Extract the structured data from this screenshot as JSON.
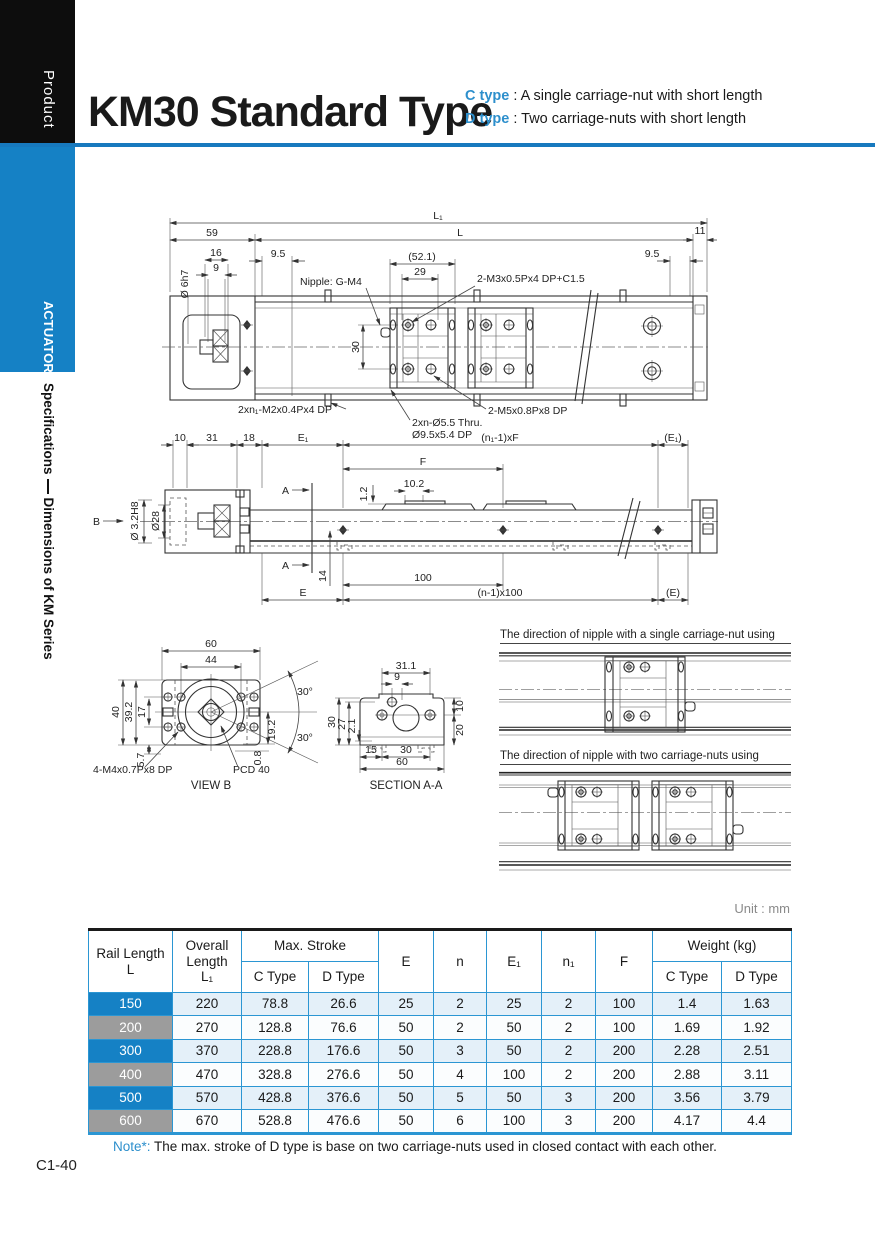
{
  "colors": {
    "accent_blue": "#1581c5",
    "rule_blue": "#1779be",
    "table_line_blue": "#2b96d3",
    "row_tint": "#e4f0f9",
    "row_label_gray": "#9c9c9c",
    "type_blue": "#2d8fcc"
  },
  "header": {
    "product": "Product",
    "title": "KM30 Standard Type",
    "c_type_label": "C type",
    "c_type_sep": " : ",
    "c_type_desc": "A single carriage-nut with short length",
    "d_type_label": "D type",
    "d_type_sep": " : ",
    "d_type_desc": "Two carriage-nuts with short length"
  },
  "sidebar": {
    "actuator": "ACTUATOR",
    "section_1": "Specifications",
    "section_2": "Dimensions of KM Series"
  },
  "drawings": {
    "top": {
      "dim_l1": "L₁",
      "dim_l": "L",
      "dim_59": "59",
      "dim_11": "11",
      "dim_16": "16",
      "dim_9": "9",
      "dim_d6": "Ø 6h7",
      "dim_95l": "9.5",
      "dim_521": "(52.1)",
      "dim_29": "29",
      "dim_30": "30",
      "dim_95r": "9.5",
      "lbl_nipple": "Nipple: G-M4",
      "lbl_m3": "2-M3x0.5Px4 DP+C1.5",
      "lbl_m2": "2xn₁-M2x0.4Px4 DP",
      "lbl_thru1": "2xn-Ø5.5 Thru.",
      "lbl_thru2": "Ø9.5x5.4 DP",
      "lbl_m5": "2-M5x0.8Px8 DP"
    },
    "side": {
      "dim_10": "10",
      "dim_31": "31",
      "dim_18": "18",
      "dim_e1": "E₁",
      "dim_nf": "(n₁-1)xF",
      "dim_e1p": "(E₁)",
      "dim_f": "F",
      "dim_12": "1.2",
      "dim_102": "10.2",
      "dim_d32": "Ø 3.2H8",
      "dim_d28": "Ø28",
      "lbl_b": "B",
      "lbl_a_top": "A",
      "lbl_a_bot": "A",
      "dim_14": "14",
      "dim_100": "100",
      "dim_e": "E",
      "dim_n100": "(n-1)x100",
      "dim_ep": "(E)"
    },
    "view_b": {
      "dim_60": "60",
      "dim_44": "44",
      "dim_40": "40",
      "dim_392": "39.2",
      "dim_17": "17",
      "dim_57": "5.7",
      "dim_30u": "30°",
      "dim_30l": "30°",
      "dim_192": "19.2",
      "dim_08": "0.8",
      "lbl_m4": "4-M4x0.7Px8 DP",
      "lbl_pcd": "PCD 40",
      "caption": "VIEW B"
    },
    "section_aa": {
      "dim_311": "31.1",
      "dim_9": "9",
      "dim_30": "30",
      "dim_27": "27",
      "dim_21": "2.1",
      "dim_10": "10",
      "dim_20": "20",
      "dim_15": "15",
      "dim_30b": "30",
      "dim_60": "60",
      "caption": "SECTION A-A"
    },
    "nipple": {
      "caption_single": "The direction of nipple with a single carriage-nut using",
      "caption_double": "The direction of nipple with two carriage-nuts using"
    }
  },
  "table": {
    "unit": "Unit : mm",
    "headers": {
      "rail_length": "Rail Length",
      "rail_length_sub": "L",
      "overall_1": "Overall",
      "overall_2": "Length",
      "overall_3": "L₁",
      "max_stroke": "Max. Stroke",
      "c_type": "C Type",
      "d_type": "D Type",
      "e": "E",
      "n": "n",
      "e1": "E₁",
      "n1": "n₁",
      "f": "F",
      "weight": "Weight (kg)",
      "c_type_w": "C Type",
      "d_type_w": "D Type"
    },
    "rows": [
      {
        "l": "150",
        "l1": "220",
        "c": "78.8",
        "d": "26.6",
        "e": "25",
        "n": "2",
        "e1": "25",
        "n1": "2",
        "f": "100",
        "wc": "1.4",
        "wd": "1.63"
      },
      {
        "l": "200",
        "l1": "270",
        "c": "128.8",
        "d": "76.6",
        "e": "50",
        "n": "2",
        "e1": "50",
        "n1": "2",
        "f": "100",
        "wc": "1.69",
        "wd": "1.92"
      },
      {
        "l": "300",
        "l1": "370",
        "c": "228.8",
        "d": "176.6",
        "e": "50",
        "n": "3",
        "e1": "50",
        "n1": "2",
        "f": "200",
        "wc": "2.28",
        "wd": "2.51"
      },
      {
        "l": "400",
        "l1": "470",
        "c": "328.8",
        "d": "276.6",
        "e": "50",
        "n": "4",
        "e1": "100",
        "n1": "2",
        "f": "200",
        "wc": "2.88",
        "wd": "3.11"
      },
      {
        "l": "500",
        "l1": "570",
        "c": "428.8",
        "d": "376.6",
        "e": "50",
        "n": "5",
        "e1": "50",
        "n1": "3",
        "f": "200",
        "wc": "3.56",
        "wd": "3.79"
      },
      {
        "l": "600",
        "l1": "670",
        "c": "528.8",
        "d": "476.6",
        "e": "50",
        "n": "6",
        "e1": "100",
        "n1": "3",
        "f": "200",
        "wc": "4.17",
        "wd": "4.4"
      }
    ]
  },
  "note": {
    "label": "Note*:",
    "text": "The max. stroke of D type is base on two carriage-nuts used in closed contact with each other."
  },
  "page_number": "C1-40"
}
